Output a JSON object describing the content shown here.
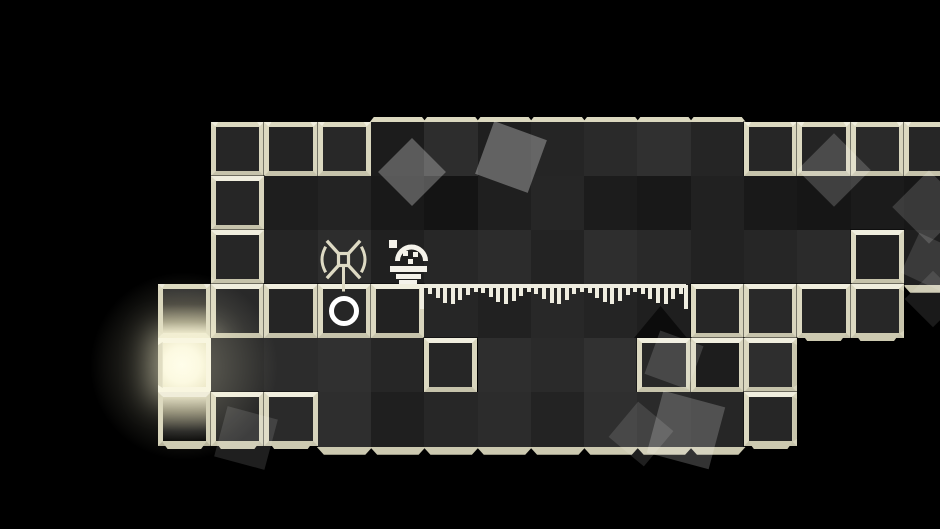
{
  "scene": {
    "name": "monochrome-tile-puzzle-room",
    "background": "#000000",
    "palette": {
      "wall_frame_cream": "#e6e3cf",
      "bevel_top": "#dbd8bf",
      "bevel_bottom": "#ccc9b0",
      "floor_dark_base": "#262626",
      "sprite_white": "#f4f2ea",
      "sprite_cream": "#dedac4",
      "glow_tile": "#fbf9e4"
    },
    "grid": {
      "origin_x": 211,
      "origin_y": 122,
      "cell_w": 53.3,
      "cell_h": 54,
      "tiles": [
        {
          "c": 0,
          "r": 0,
          "t": "s",
          "f": "#262626",
          "e": "tl"
        },
        {
          "c": 1,
          "r": 0,
          "t": "s",
          "f": "#242424",
          "e": "t"
        },
        {
          "c": 2,
          "r": 0,
          "t": "s",
          "f": "#282828",
          "e": "t"
        },
        {
          "c": 3,
          "r": 0,
          "t": "d",
          "f": "#1c1c1c",
          "e": "t"
        },
        {
          "c": 4,
          "r": 0,
          "t": "d",
          "f": "#2d2d2d",
          "e": "t"
        },
        {
          "c": 5,
          "r": 0,
          "t": "d",
          "f": "#1f1f1f",
          "e": "t"
        },
        {
          "c": 6,
          "r": 0,
          "t": "d",
          "f": "#252525",
          "e": "t"
        },
        {
          "c": 7,
          "r": 0,
          "t": "d",
          "f": "#2a2a2a",
          "e": "t"
        },
        {
          "c": 8,
          "r": 0,
          "t": "d",
          "f": "#303030",
          "e": "t"
        },
        {
          "c": 9,
          "r": 0,
          "t": "d",
          "f": "#252525",
          "e": "t"
        },
        {
          "c": 10,
          "r": 0,
          "t": "s",
          "f": "#262626",
          "e": "t"
        },
        {
          "c": 11,
          "r": 0,
          "t": "s",
          "f": "#242424",
          "e": "t"
        },
        {
          "c": 12,
          "r": 0,
          "t": "s",
          "f": "#2a2a2a",
          "e": "t"
        },
        {
          "c": 13,
          "r": 0,
          "t": "s",
          "f": "#262626",
          "e": "t"
        },
        {
          "c": 0,
          "r": 1,
          "t": "s",
          "f": "#262626",
          "e": "l"
        },
        {
          "c": 1,
          "r": 1,
          "t": "d",
          "f": "#1e1e1e",
          "e": ""
        },
        {
          "c": 2,
          "r": 1,
          "t": "d",
          "f": "#232323",
          "e": ""
        },
        {
          "c": 3,
          "r": 1,
          "t": "d",
          "f": "#191919",
          "e": ""
        },
        {
          "c": 4,
          "r": 1,
          "t": "d",
          "f": "#141414",
          "e": ""
        },
        {
          "c": 5,
          "r": 1,
          "t": "d",
          "f": "#1f1f1f",
          "e": ""
        },
        {
          "c": 6,
          "r": 1,
          "t": "d",
          "f": "#262626",
          "e": ""
        },
        {
          "c": 7,
          "r": 1,
          "t": "d",
          "f": "#1c1c1c",
          "e": ""
        },
        {
          "c": 8,
          "r": 1,
          "t": "d",
          "f": "#181818",
          "e": ""
        },
        {
          "c": 9,
          "r": 1,
          "t": "d",
          "f": "#212121",
          "e": ""
        },
        {
          "c": 10,
          "r": 1,
          "t": "d",
          "f": "#191919",
          "e": ""
        },
        {
          "c": 11,
          "r": 1,
          "t": "d",
          "f": "#161616",
          "e": ""
        },
        {
          "c": 12,
          "r": 1,
          "t": "d",
          "f": "#1b1b1b",
          "e": ""
        },
        {
          "c": 13,
          "r": 1,
          "t": "d",
          "f": "#171717",
          "e": ""
        },
        {
          "c": 0,
          "r": 2,
          "t": "s",
          "f": "#262626",
          "e": "l"
        },
        {
          "c": 1,
          "r": 2,
          "t": "d",
          "f": "#252525",
          "e": ""
        },
        {
          "c": 2,
          "r": 2,
          "t": "d",
          "f": "#2d2d2d",
          "e": ""
        },
        {
          "c": 3,
          "r": 2,
          "t": "d",
          "f": "#202020",
          "e": ""
        },
        {
          "c": 4,
          "r": 2,
          "t": "d",
          "f": "#272727",
          "e": ""
        },
        {
          "c": 5,
          "r": 2,
          "t": "d",
          "f": "#2c2c2c",
          "e": ""
        },
        {
          "c": 6,
          "r": 2,
          "t": "d",
          "f": "#232323",
          "e": ""
        },
        {
          "c": 7,
          "r": 2,
          "t": "d",
          "f": "#2e2e2e",
          "e": ""
        },
        {
          "c": 8,
          "r": 2,
          "t": "d",
          "f": "#292929",
          "e": ""
        },
        {
          "c": 9,
          "r": 2,
          "t": "d",
          "f": "#222222",
          "e": ""
        },
        {
          "c": 10,
          "r": 2,
          "t": "d",
          "f": "#262626",
          "e": ""
        },
        {
          "c": 11,
          "r": 2,
          "t": "d",
          "f": "#2b2b2b",
          "e": ""
        },
        {
          "c": 12,
          "r": 2,
          "t": "s",
          "f": "#222222",
          "e": ""
        },
        {
          "c": 13,
          "r": 2,
          "t": "d",
          "f": "#1f1f1f",
          "e": "b"
        },
        {
          "c": -1,
          "r": 3,
          "t": "ga",
          "f": "",
          "e": "tl"
        },
        {
          "c": 0,
          "r": 3,
          "t": "s",
          "f": "#292929",
          "e": ""
        },
        {
          "c": 1,
          "r": 3,
          "t": "s",
          "f": "#252525",
          "e": ""
        },
        {
          "c": 2,
          "r": 3,
          "t": "s",
          "f": "#262626",
          "e": "",
          "ring": true
        },
        {
          "c": 3,
          "r": 3,
          "t": "s",
          "f": "#222222",
          "e": ""
        },
        {
          "c": 4,
          "r": 3,
          "t": "d",
          "f": "#262626",
          "e": ""
        },
        {
          "c": 5,
          "r": 3,
          "t": "d",
          "f": "#212121",
          "e": ""
        },
        {
          "c": 6,
          "r": 3,
          "t": "d",
          "f": "#282828",
          "e": ""
        },
        {
          "c": 7,
          "r": 3,
          "t": "d",
          "f": "#242424",
          "e": ""
        },
        {
          "c": 8,
          "r": 3,
          "t": "d",
          "f": "#1f1f1f",
          "e": ""
        },
        {
          "c": 9,
          "r": 3,
          "t": "s",
          "f": "#262626",
          "e": ""
        },
        {
          "c": 10,
          "r": 3,
          "t": "s",
          "f": "#292929",
          "e": ""
        },
        {
          "c": 11,
          "r": 3,
          "t": "s",
          "f": "#242424",
          "e": "b"
        },
        {
          "c": 12,
          "r": 3,
          "t": "s",
          "f": "#272727",
          "e": "br"
        },
        {
          "c": -1,
          "r": 4,
          "t": "g",
          "f": "",
          "e": "l"
        },
        {
          "c": 0,
          "r": 4,
          "t": "d",
          "f": "#272727",
          "e": ""
        },
        {
          "c": 1,
          "r": 4,
          "t": "d",
          "f": "#2c2c2c",
          "e": ""
        },
        {
          "c": 2,
          "r": 4,
          "t": "d",
          "f": "#303030",
          "e": ""
        },
        {
          "c": 3,
          "r": 4,
          "t": "d",
          "f": "#262626",
          "e": ""
        },
        {
          "c": 4,
          "r": 4,
          "t": "s",
          "f": "#262626",
          "e": ""
        },
        {
          "c": 5,
          "r": 4,
          "t": "d",
          "f": "#2e2e2e",
          "e": ""
        },
        {
          "c": 6,
          "r": 4,
          "t": "d",
          "f": "#2a2a2a",
          "e": ""
        },
        {
          "c": 7,
          "r": 4,
          "t": "d",
          "f": "#313131",
          "e": ""
        },
        {
          "c": 8,
          "r": 4,
          "t": "s",
          "f": "#282828",
          "e": ""
        },
        {
          "c": 9,
          "r": 4,
          "t": "s",
          "f": "#1d1d1d",
          "e": ""
        },
        {
          "c": 10,
          "r": 4,
          "t": "s",
          "f": "#2e2e2e",
          "e": "r"
        },
        {
          "c": -1,
          "r": 5,
          "t": "gb",
          "f": "",
          "e": "lb"
        },
        {
          "c": 0,
          "r": 5,
          "t": "s",
          "f": "#242424",
          "e": "b"
        },
        {
          "c": 1,
          "r": 5,
          "t": "s",
          "f": "#2a2a2a",
          "e": "b"
        },
        {
          "c": 2,
          "r": 5,
          "t": "d",
          "f": "#2e2e2e",
          "e": "b"
        },
        {
          "c": 3,
          "r": 5,
          "t": "d",
          "f": "#1f1f1f",
          "e": "b"
        },
        {
          "c": 4,
          "r": 5,
          "t": "d",
          "f": "#272727",
          "e": "b"
        },
        {
          "c": 5,
          "r": 5,
          "t": "d",
          "f": "#2c2c2c",
          "e": "b"
        },
        {
          "c": 6,
          "r": 5,
          "t": "d",
          "f": "#232323",
          "e": "b"
        },
        {
          "c": 7,
          "r": 5,
          "t": "d",
          "f": "#2f2f2f",
          "e": "b"
        },
        {
          "c": 8,
          "r": 5,
          "t": "d",
          "f": "#2a2a2a",
          "e": "b"
        },
        {
          "c": 9,
          "r": 5,
          "t": "d",
          "f": "#262626",
          "e": "b"
        },
        {
          "c": 10,
          "r": 5,
          "t": "s",
          "f": "#262626",
          "e": "br"
        }
      ]
    },
    "glow": {
      "cx": 184,
      "cy": 366,
      "radius": 95,
      "color": "rgba(255,250,215,0.30)"
    },
    "shadow_triangle": {
      "x": 634,
      "y": 306,
      "w": 53,
      "h": 32,
      "color": "rgba(8,8,8,0.8)"
    },
    "waveform": {
      "x": 420,
      "y": 282,
      "width": 268,
      "line_h": 4,
      "cap_h": 24,
      "cap_w": 4,
      "bar_w": 4,
      "bar_pitch": 7.6,
      "bar_color": "#efede0",
      "bar_lengths": [
        6,
        10,
        15,
        16,
        12,
        7,
        4,
        5,
        9,
        14,
        16,
        13,
        8,
        4,
        6,
        11,
        15,
        16,
        12,
        6,
        4,
        5,
        10,
        14,
        16,
        13,
        7,
        4,
        6,
        11,
        15,
        16,
        11,
        6
      ]
    },
    "decor_squares": [
      {
        "cx": 412,
        "cy": 172,
        "size": 48,
        "rot": 45,
        "op": 0.28
      },
      {
        "cx": 511,
        "cy": 157,
        "size": 56,
        "rot": 20,
        "op": 0.3
      },
      {
        "cx": 834,
        "cy": 170,
        "size": 52,
        "rot": 45,
        "op": 0.18
      },
      {
        "cx": 929,
        "cy": 207,
        "size": 52,
        "rot": 45,
        "op": 0.15
      },
      {
        "cx": 930,
        "cy": 262,
        "size": 44,
        "rot": 25,
        "op": 0.12
      },
      {
        "cx": 933,
        "cy": 299,
        "size": 40,
        "rot": 45,
        "op": 0.1
      },
      {
        "cx": 674,
        "cy": 360,
        "size": 46,
        "rot": 20,
        "op": 0.15
      },
      {
        "cx": 686,
        "cy": 430,
        "size": 64,
        "rot": 15,
        "op": 0.2
      },
      {
        "cx": 641,
        "cy": 434,
        "size": 46,
        "rot": 40,
        "op": 0.12
      },
      {
        "cx": 246,
        "cy": 438,
        "size": 52,
        "rot": 15,
        "op": 0.12
      }
    ],
    "sprites": {
      "antenna_figure": {
        "icon": "antenna-flower-icon",
        "x": 312,
        "y": 233,
        "color": "#dedac4"
      },
      "robot": {
        "icon": "robot-lamp-icon",
        "x": 385,
        "y": 237,
        "color": "#f4f2ea"
      },
      "ring_tile_mark": {
        "icon": "circle-ring-icon",
        "color": "#ffffff"
      }
    }
  }
}
